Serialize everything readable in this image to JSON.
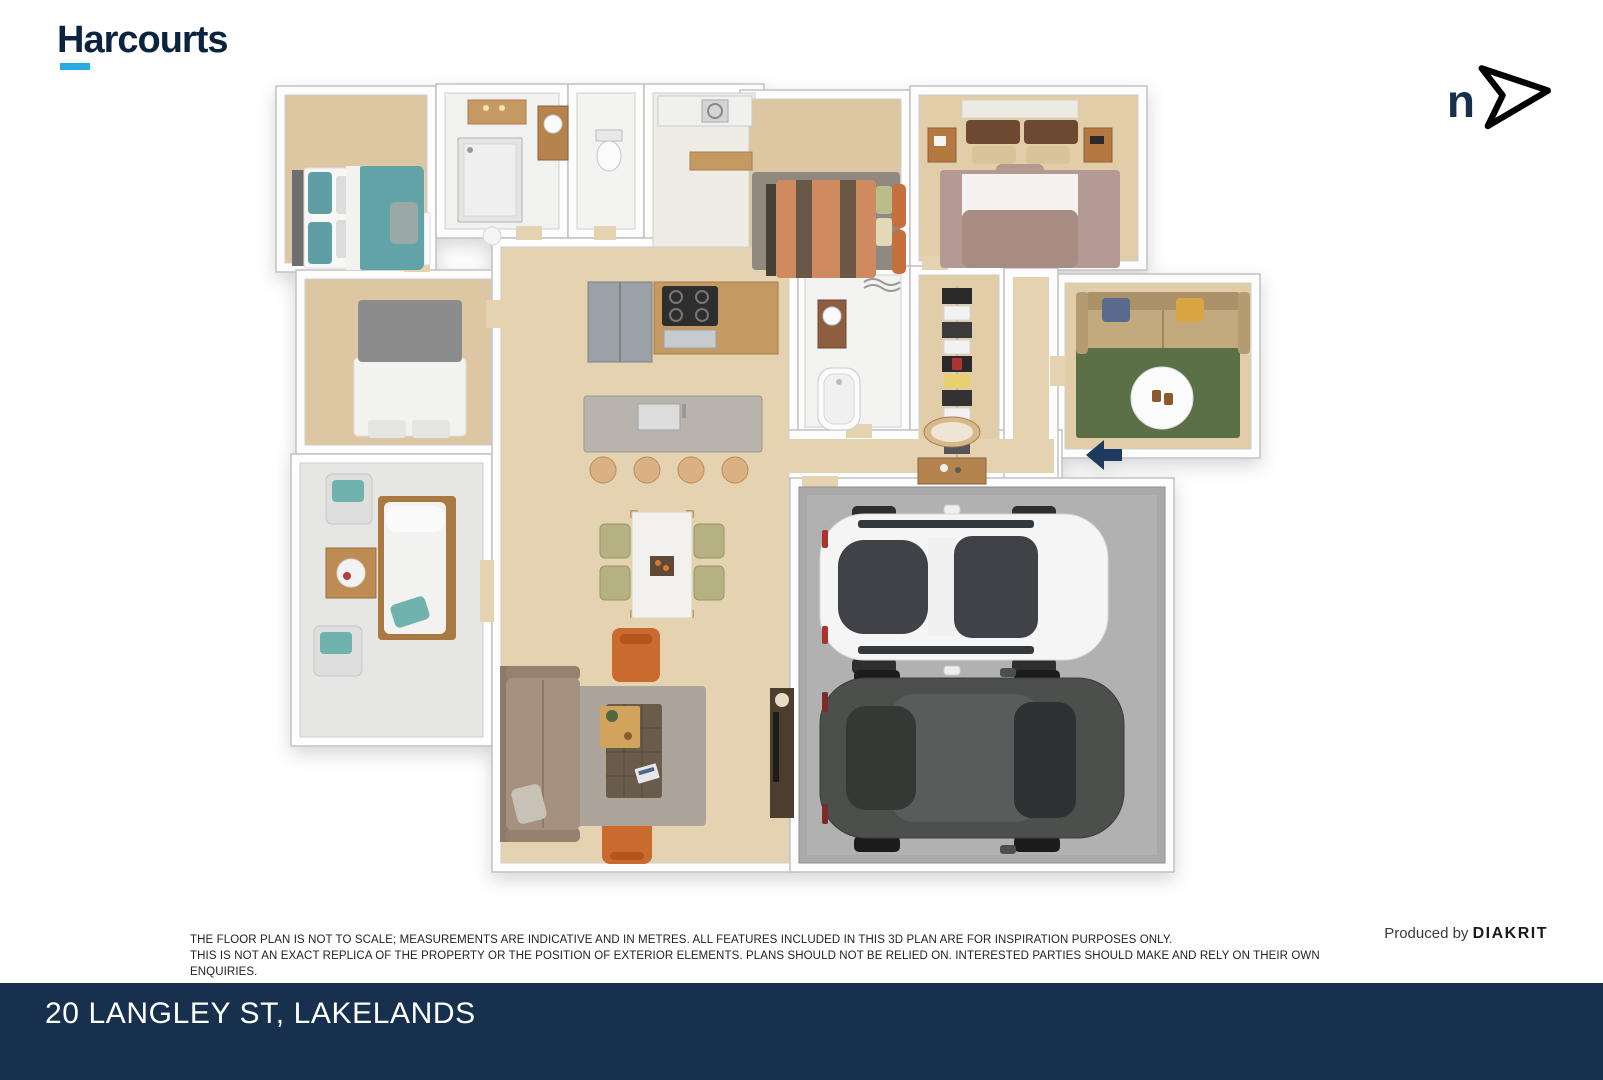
{
  "brand": {
    "name": "Harcourts",
    "text_color": "#0c2340",
    "underline_color": "#29abe2"
  },
  "compass": {
    "label": "n",
    "icon": "north-arrow-icon"
  },
  "floorplan": {
    "kind": "3d-floorplan-render",
    "rooms": [
      "bedroom-1",
      "ensuite",
      "wc",
      "laundry",
      "bedroom-2",
      "master-bedroom",
      "bedroom-3",
      "kitchen",
      "island-bench",
      "bathroom",
      "walk-in-robe",
      "hall-console",
      "lounge-room",
      "sitting-room",
      "dining-area",
      "living-room",
      "garage"
    ],
    "vehicles": [
      "white-car",
      "dark-car"
    ],
    "entry_arrow_direction": "left",
    "palette": {
      "wood_floor": "#e2cda9",
      "tile_floor": "#f1f1f0",
      "carpet": "#e6e6e4",
      "garage_floor": "#a9a9a9",
      "wall": "#fdfdfd",
      "teal_bed": "#62a3a8",
      "orange_bed": "#d08a5e",
      "mauve_bed": "#a88c82",
      "green_rug": "#5c6f47",
      "tan_sofa": "#c3aa7e",
      "orange_chair": "#c96a2f",
      "entry_arrow": "#1d3a5f"
    }
  },
  "disclaimer": {
    "line1": "THE FLOOR PLAN IS NOT TO SCALE; MEASUREMENTS ARE INDICATIVE AND IN METRES. ALL FEATURES INCLUDED IN THIS 3D PLAN ARE FOR INSPIRATION PURPOSES ONLY.",
    "line2": "THIS IS NOT AN EXACT REPLICA OF THE PROPERTY OR THE POSITION OF EXTERIOR ELEMENTS. PLANS SHOULD NOT BE RELIED ON. INTERESTED PARTIES SHOULD MAKE AND RELY ON THEIR OWN ENQUIRIES."
  },
  "credit": {
    "prefix": "Produced by",
    "producer": "DIAKRIT"
  },
  "footer": {
    "address": "20 LANGLEY ST, LAKELANDS",
    "bar_color": "#16304d"
  }
}
